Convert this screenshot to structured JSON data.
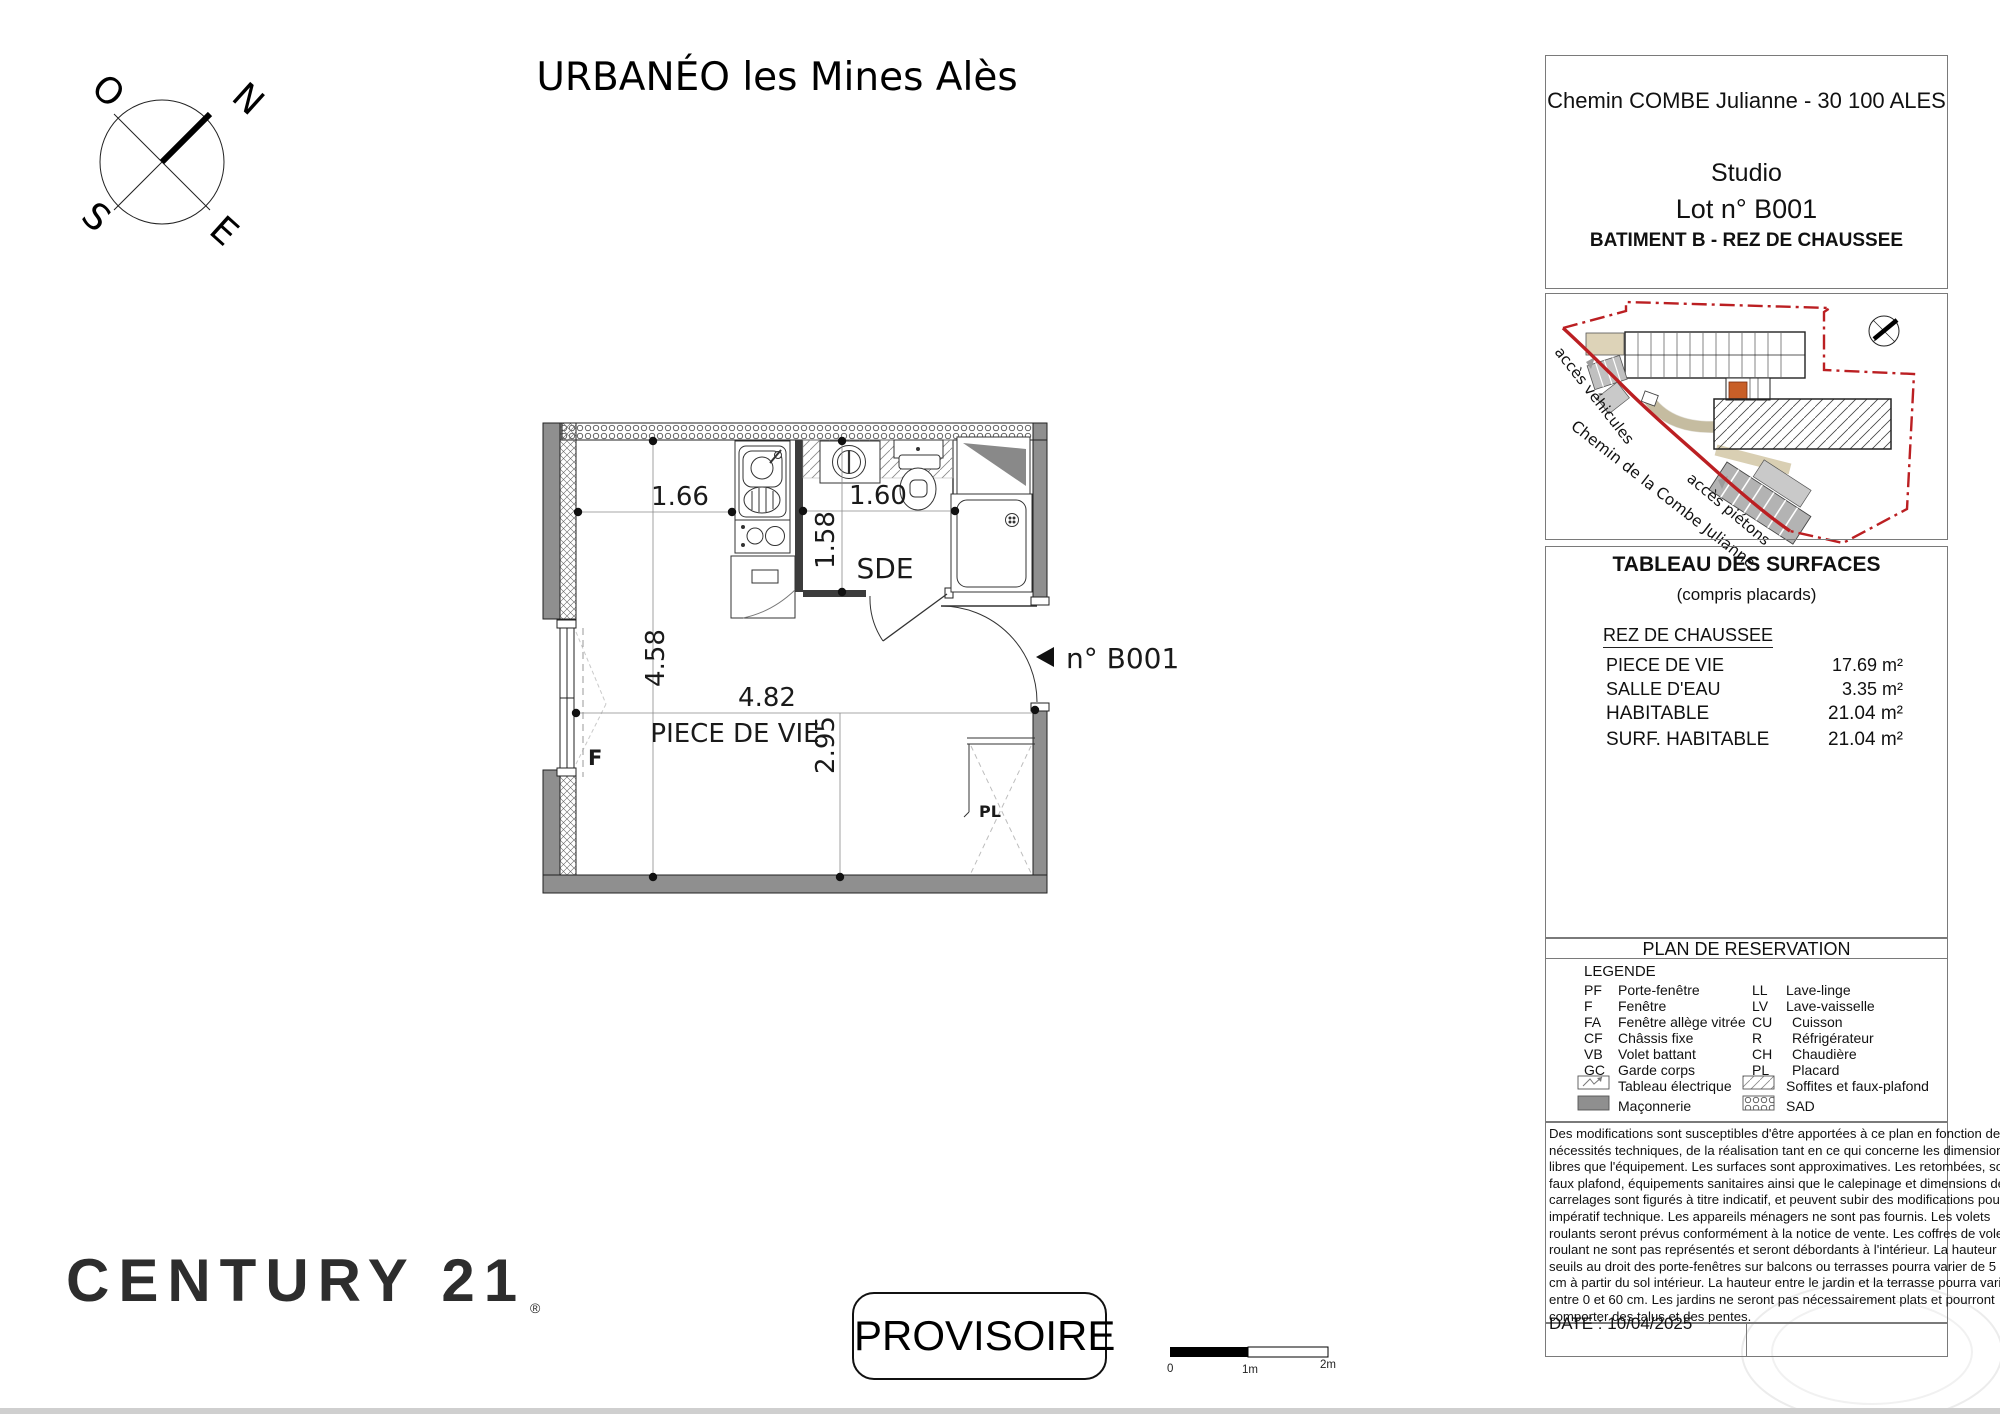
{
  "page": {
    "title": "URBANÉO les Mines Alès"
  },
  "compass": {
    "n": "N",
    "o": "O",
    "s": "S",
    "e": "E"
  },
  "plan": {
    "room_living": "PIECE DE VIE",
    "room_bath": "SDE",
    "unit_label": "n° B001",
    "window_label": "F",
    "closet_label": "PL",
    "dims": {
      "kitchen_width": "1.66",
      "bath_width": "1.60",
      "living_depth": "4.58",
      "living_width": "4.82",
      "living_height2": "2.95",
      "bath_depth": "1.58"
    }
  },
  "site": {
    "access_vehicles": "accès véhicules",
    "road_name": "Chemin de la Combe Julianne",
    "access_pedestrians": "accès piétons",
    "boundary_color": "#bb1f22",
    "highlight_unit_color": "#c85f28"
  },
  "panel": {
    "address": "Chemin COMBE Julianne - 30 100 ALES",
    "unit_type": "Studio",
    "lot": "Lot n° B001",
    "building": "BATIMENT B - REZ DE CHAUSSEE",
    "surfaces": {
      "title": "TABLEAU DES SURFACES",
      "subtitle": "(compris placards)",
      "floor": "REZ DE CHAUSSEE",
      "rows": [
        {
          "label": "PIECE DE VIE",
          "value": "17.69 m²"
        },
        {
          "label": "SALLE D'EAU",
          "value": "3.35 m²"
        },
        {
          "label": "HABITABLE",
          "value": "21.04 m²"
        },
        {
          "label": "SURF. HABITABLE",
          "value": "21.04 m²"
        }
      ]
    },
    "reservation": {
      "title": "PLAN DE RESERVATION",
      "legend_title": "LEGENDE",
      "left": [
        {
          "code": "PF",
          "label": "Porte-fenêtre"
        },
        {
          "code": "F",
          "label": "Fenêtre"
        },
        {
          "code": "FA",
          "label": "Fenêtre allège vitrée"
        },
        {
          "code": "CF",
          "label": "Châssis fixe"
        },
        {
          "code": "VB",
          "label": "Volet battant"
        },
        {
          "code": "GC",
          "label": "Garde corps"
        }
      ],
      "left_icons": [
        {
          "icon": "electrical-panel",
          "label": "Tableau électrique"
        },
        {
          "icon": "masonry",
          "label": "Maçonnerie"
        }
      ],
      "right": [
        {
          "code": "LL",
          "label": "Lave-linge"
        },
        {
          "code": "LV",
          "label": "Lave-vaisselle"
        },
        {
          "code": "CU",
          "label": "Cuisson"
        },
        {
          "code": "R",
          "label": "Réfrigérateur"
        },
        {
          "code": "CH",
          "label": "Chaudière"
        },
        {
          "code": "PL",
          "label": "Placard"
        }
      ],
      "right_icons": [
        {
          "icon": "soffit-hatch",
          "label": "Soffites et faux-plafond"
        },
        {
          "icon": "sad-pattern",
          "label": "SAD"
        }
      ]
    },
    "disclaimer_lines": [
      "Des modifications sont susceptibles d'être apportées à ce plan en fonction des",
      "nécessités techniques, de la réalisation tant en ce qui concerne les dimensions",
      "libres que l'équipement. Les surfaces sont approximatives. Les retombées, soffites,",
      "faux plafond, équipements sanitaires ainsi que le calepinage et dimensions des",
      "carrelages sont figurés à titre indicatif, et peuvent subir des modifications pour",
      "impératif technique. Les appareils ménagers ne sont pas fournis. Les volets",
      "roulants seront prévus conformément à la notice de vente. Les coffres de volet",
      "roulant ne sont pas représentés et seront débordants à l'intérieur. La hauteur des",
      "seuils au droit des porte-fenêtres sur balcons ou terrasses pourra varier de 5 à 25",
      "cm à partir du sol intérieur. La hauteur entre le jardin et la terrasse pourra varier",
      "entre 0 et 60 cm. Les jardins ne seront pas nécessairement plats et pourront",
      "comporter des talus et des pentes."
    ],
    "date": "DATE : 10/04/2025"
  },
  "footer": {
    "brand": "CENTURY 21",
    "registered": "®",
    "stamp": "PROVISOIRE",
    "scalebar": {
      "t0": "0",
      "t1": "1m",
      "t2": "2m"
    }
  }
}
